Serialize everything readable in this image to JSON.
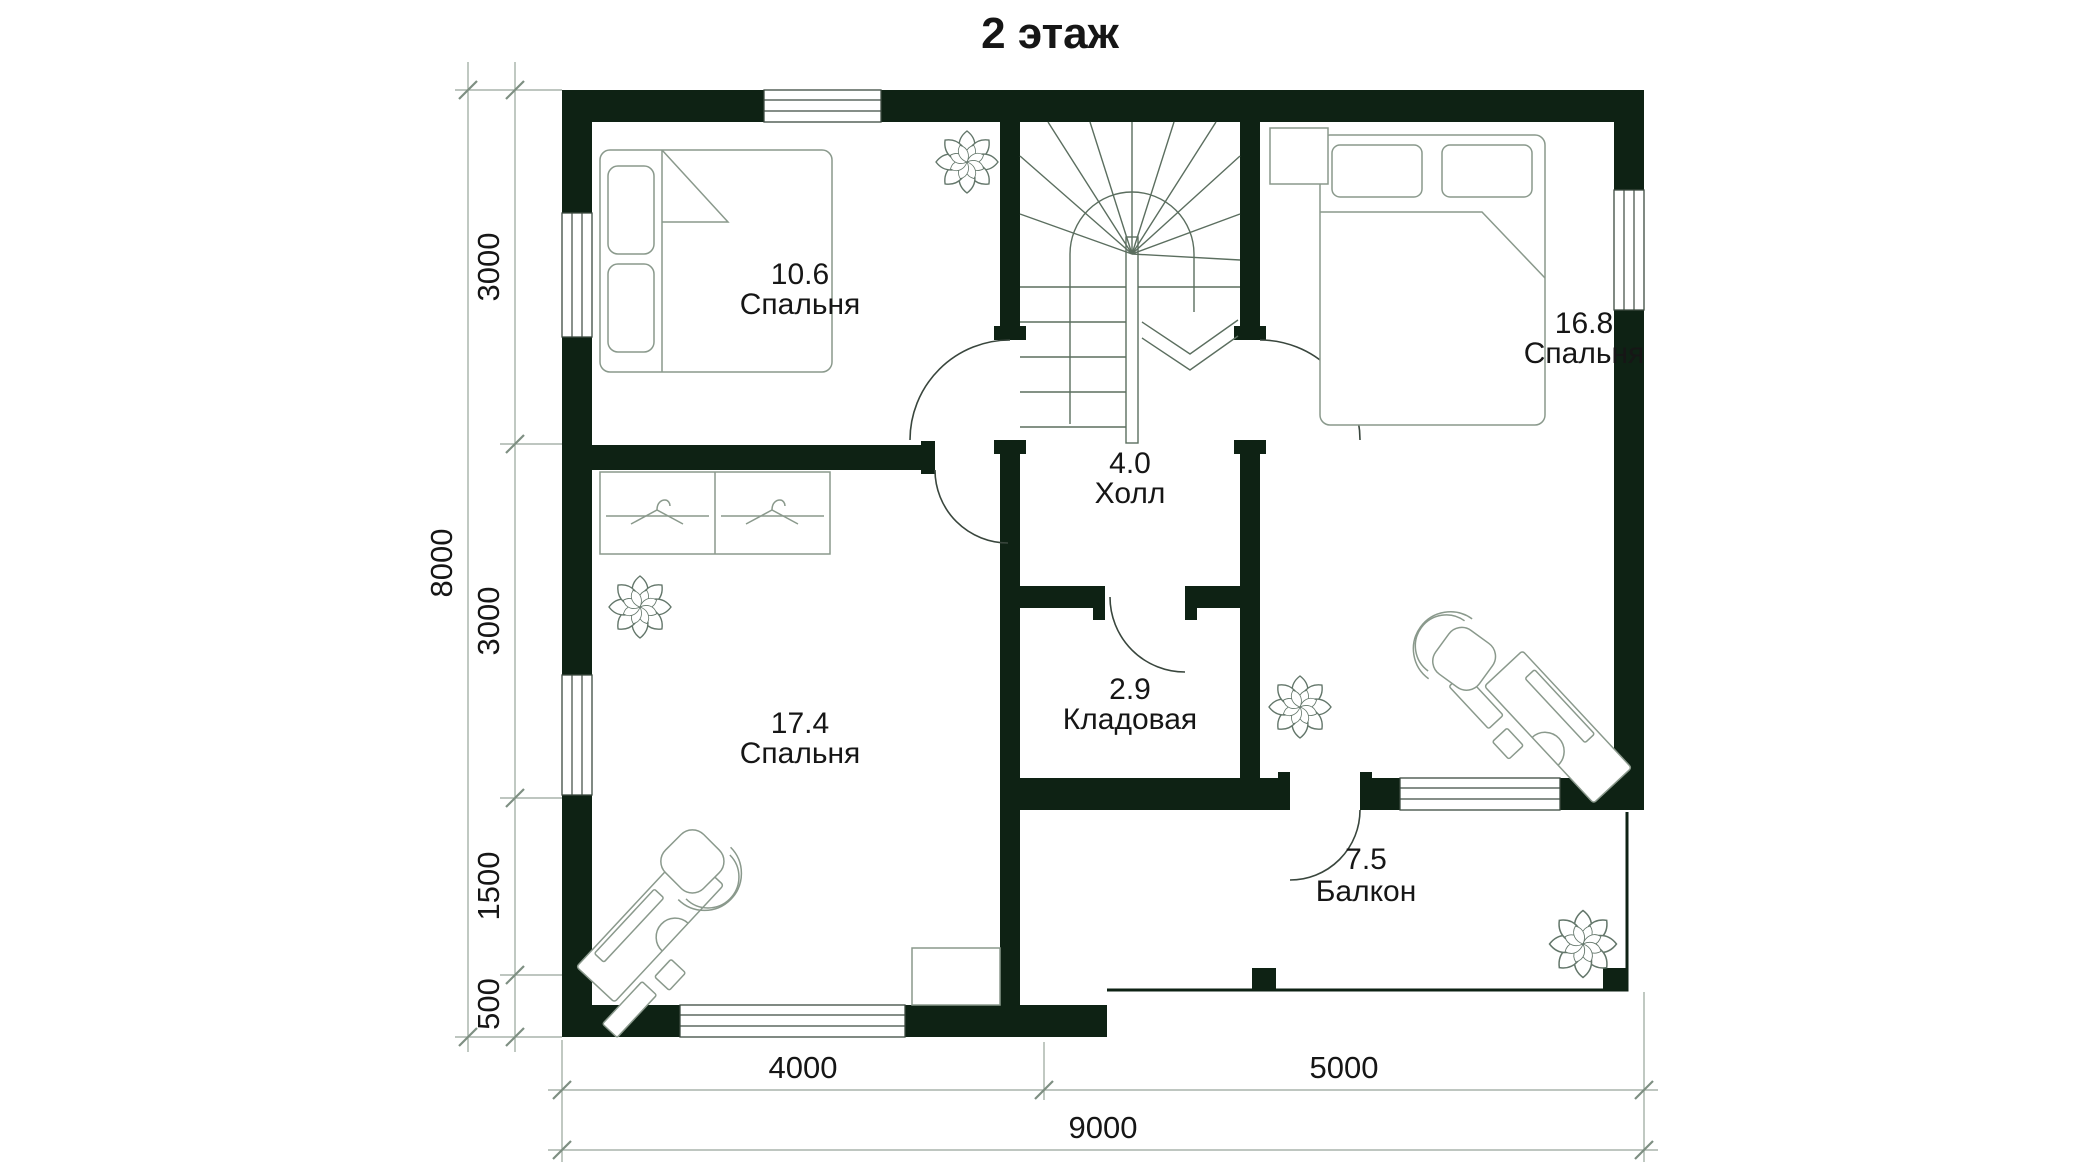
{
  "title": "2 этаж",
  "floor_plan": {
    "rooms": [
      {
        "area": "10.6",
        "name": "Спальня"
      },
      {
        "area": "16.8",
        "name": "Спальня"
      },
      {
        "area": "4.0",
        "name": "Холл"
      },
      {
        "area": "2.9",
        "name": "Кладовая"
      },
      {
        "area": "17.4",
        "name": "Спальня"
      },
      {
        "area": "7.5",
        "name": "Балкон"
      }
    ],
    "dimensions_left": {
      "total": "8000",
      "segments": [
        "3000",
        "3000",
        "1500",
        "500"
      ]
    },
    "dimensions_bottom": {
      "total": "9000",
      "segments": [
        "4000",
        "5000"
      ]
    }
  },
  "colors": {
    "wall": "#0e2214",
    "frame": "#3c4a40",
    "door": "#39463d",
    "stair": "#5b6e5f",
    "furn": "#8a998c",
    "plant": "#63766a",
    "dim": "#97a59a",
    "dimtick": "#7e8f82",
    "text": "#161616"
  }
}
